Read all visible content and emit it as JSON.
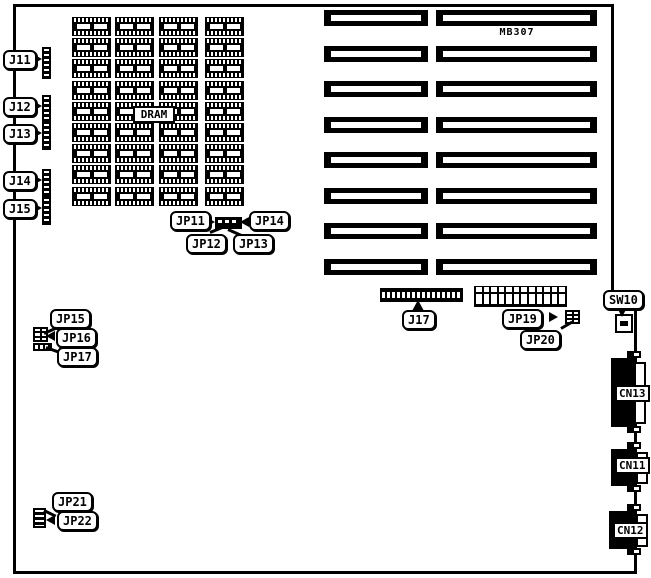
{
  "board": {
    "model": "MB307"
  },
  "labels": {
    "j11": "J11",
    "j12": "J12",
    "j13": "J13",
    "j14": "J14",
    "j15": "J15",
    "jp11": "JP11",
    "jp12": "JP12",
    "jp13": "JP13",
    "jp14": "JP14",
    "jp15": "JP15",
    "jp16": "JP16",
    "jp17": "JP17",
    "j17": "J17",
    "jp19": "JP19",
    "jp20": "JP20",
    "jp21": "JP21",
    "jp22": "JP22",
    "sw10": "SW10",
    "cn13": "CN13",
    "cn11": "CN11",
    "cn12": "CN12"
  },
  "components": {
    "dram_bank": {
      "label": "DRAM",
      "columns": 4,
      "rows": 9
    },
    "expansion_slots": {
      "rows": 8,
      "segments_per_row": 2
    },
    "jp19_connector": {
      "cells": 12
    }
  }
}
